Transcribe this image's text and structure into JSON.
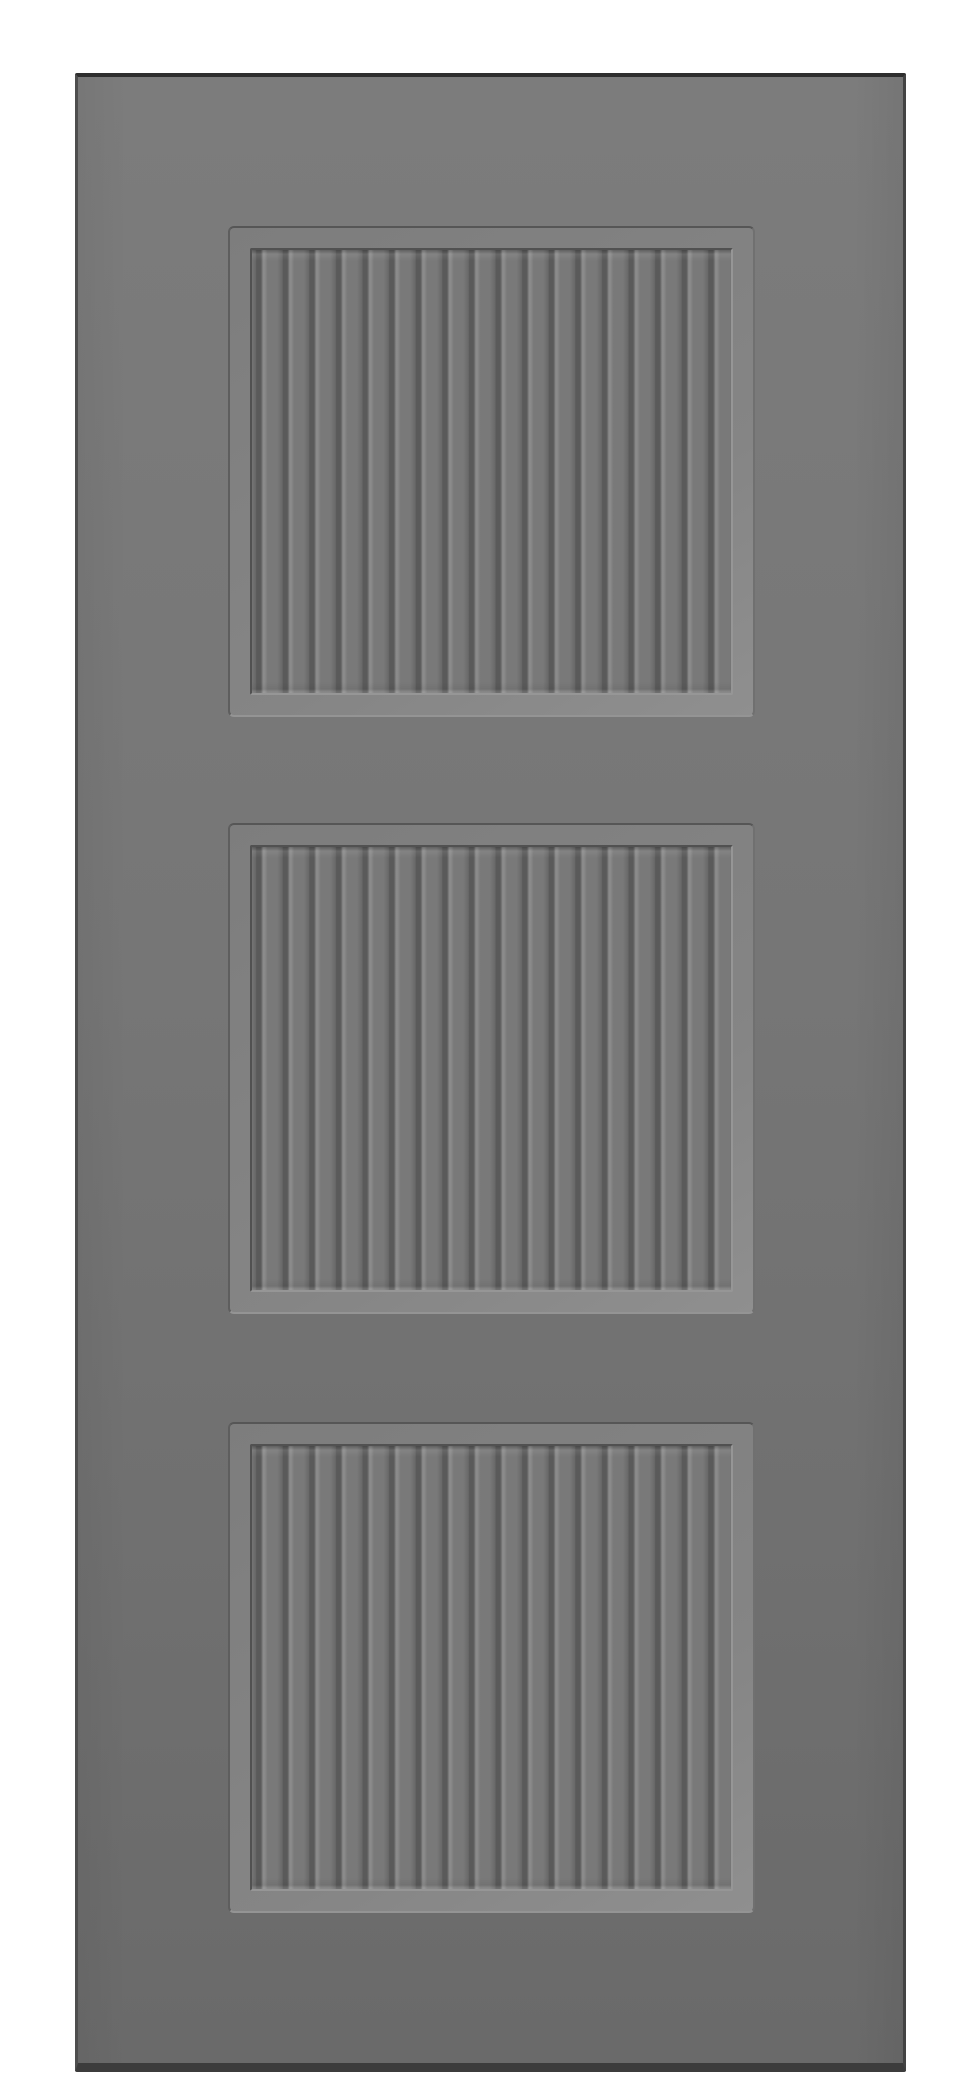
{
  "meta": {
    "description": "Front view photograph of a gray interior door slab on a plain white background. The door has three equal square recessed panels, each filled with vertical beadboard slats and framed by a beveled molding. No text, hardware, hinges or handle are visible.",
    "object": "three-panel beadboard door slab"
  },
  "door": {
    "panel_count": 3,
    "slats_per_panel": 18,
    "colors": {
      "background": "#ffffff",
      "face-top": "#7c7c7c",
      "face": "#767676",
      "face-bottom": "#6a6a6a",
      "edge-top": "#2e2e2e",
      "edge-left": "#4e4e4e",
      "edge-right": "#434343",
      "edge-bottom": "#3c3c3c",
      "panel-outline-dark": "#565656",
      "panel-outline-mid": "#707070",
      "panel-outline-left": "#5e5e5e",
      "panel-outline-light": "#949494",
      "bevel-base": "#7d7d7d",
      "bevel-light": "#858585",
      "bevel-lighter": "#8f8f8f",
      "recess-dark": "#515151",
      "recess-light": "#969696",
      "groove": "#5a5a5a",
      "slat-face": "#797979",
      "slat-highlight": "#8b8b8b",
      "slat-shade": "#696969"
    }
  },
  "panels": [
    {
      "name": "top"
    },
    {
      "name": "middle"
    },
    {
      "name": "bottom"
    }
  ]
}
